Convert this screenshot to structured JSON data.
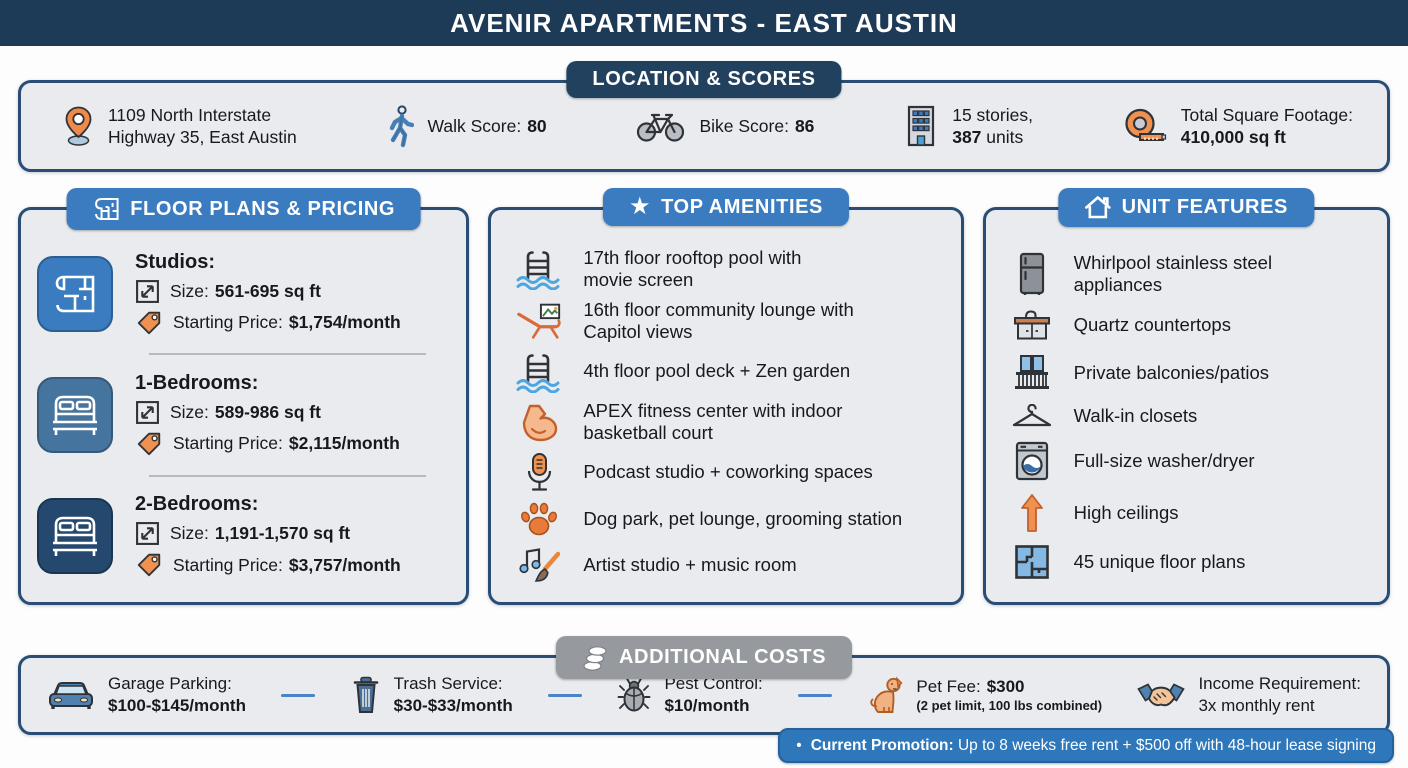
{
  "title": "AVENIR APARTMENTS - EAST AUSTIN",
  "icons": {
    "star": "★",
    "bullet": "•"
  },
  "colors": {
    "navy_bar": "#1d3a56",
    "badge_navy": "#21415f",
    "badge_blue": "#3a7cbf",
    "badge_gray": "#96999e",
    "promo_blue": "#2e77bb",
    "accent_orange": "#f0914f",
    "card_bg": "#e9ebee",
    "card_border": "#2a4d74"
  },
  "location": {
    "badge": "LOCATION & SCORES",
    "address": "1109 North Interstate\nHighway 35, East Austin",
    "walk": {
      "label": "Walk Score:",
      "value": "80"
    },
    "bike": {
      "label": "Bike Score:",
      "value": "86"
    },
    "building": {
      "line1": "15 stories,",
      "units_bold": "387",
      "units_rest": " units"
    },
    "sqft": {
      "label": "Total Square Footage:",
      "value": "410,000 sq ft"
    }
  },
  "floor_plans": {
    "badge": "FLOOR PLANS & PRICING",
    "size_label": "Size:",
    "price_label": "Starting Price:",
    "items": [
      {
        "icon": "floor-plan-icon",
        "name": "Studios:",
        "size": "561-695 sq ft",
        "price": "$1,754/month"
      },
      {
        "icon": "bed-icon",
        "name": "1-Bedrooms:",
        "size": "589-986 sq ft",
        "price": "$2,115/month"
      },
      {
        "icon": "bed-icon",
        "name": "2-Bedrooms:",
        "size": "1,191-1,570 sq ft",
        "price": "$3,757/month"
      }
    ]
  },
  "amenities": {
    "badge": "TOP AMENITIES",
    "items": [
      {
        "icon": "pool-ladder-icon",
        "text": "17th floor rooftop pool with\nmovie screen"
      },
      {
        "icon": "lounge-chair-icon",
        "text": "16th floor community lounge with\nCapitol views"
      },
      {
        "icon": "pool-ladder-icon",
        "text": "4th floor pool deck + Zen garden"
      },
      {
        "icon": "flexed-bicep-icon",
        "text": "APEX fitness center with indoor\nbasketball court"
      },
      {
        "icon": "microphone-icon",
        "text": "Podcast studio + coworking spaces"
      },
      {
        "icon": "paw-print-icon",
        "text": "Dog park, pet lounge, grooming station"
      },
      {
        "icon": "music-art-icon",
        "text": "Artist studio + music room"
      }
    ]
  },
  "unit_features": {
    "badge": "UNIT FEATURES",
    "items": [
      {
        "icon": "refrigerator-icon",
        "text": "Whirlpool stainless steel\nappliances"
      },
      {
        "icon": "countertop-icon",
        "text": "Quartz countertops"
      },
      {
        "icon": "balcony-icon",
        "text": "Private balconies/patios"
      },
      {
        "icon": "hanger-icon",
        "text": "Walk-in closets"
      },
      {
        "icon": "washer-icon",
        "text": "Full-size washer/dryer"
      },
      {
        "icon": "up-arrow-icon",
        "text": "High ceilings"
      },
      {
        "icon": "floor-plan-grid-icon",
        "text": "45 unique floor plans"
      }
    ]
  },
  "additional_costs": {
    "badge": "ADDITIONAL COSTS",
    "items": [
      {
        "icon": "car-icon",
        "label": "Garage Parking:",
        "value": "$100-$145/month"
      },
      {
        "icon": "trash-can-icon",
        "label": "Trash Service:",
        "value": "$30-$33/month"
      },
      {
        "icon": "bug-icon",
        "label": "Pest Control:",
        "value": "$10/month"
      },
      {
        "icon": "dog-icon",
        "label": "Pet Fee:",
        "value": "$300",
        "note": "(2 pet limit, 100 lbs combined)"
      },
      {
        "icon": "handshake-icon",
        "label": "Income Requirement:",
        "value": "3x monthly rent"
      }
    ]
  },
  "promotion": {
    "label": "Current Promotion:",
    "text": "Up to 8 weeks free rent + $500 off with 48-hour lease signing"
  }
}
